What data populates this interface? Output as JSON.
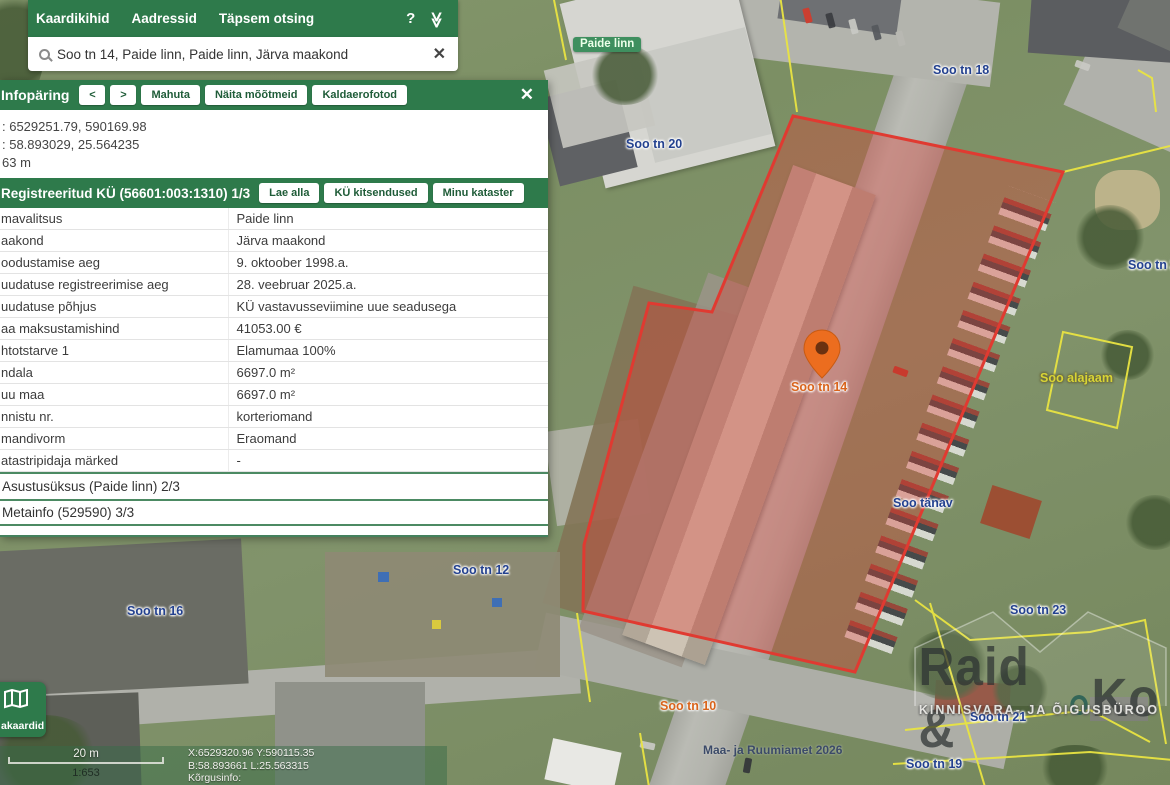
{
  "topbar": {
    "menu": [
      "Kaardikihid",
      "Aadressid",
      "Täpsem otsing"
    ],
    "help_icon": "?",
    "collapse_icon": "≫"
  },
  "search": {
    "value": "Soo tn 14, Paide linn, Paide linn, Järva maakond",
    "clear_icon": "✕"
  },
  "info_panel": {
    "title": "Infopäring",
    "nav_prev": "<",
    "nav_next": ">",
    "toolbar": [
      "Mahuta",
      "Näita mõõtmeid",
      "Kaldaerofotod"
    ],
    "close_icon": "✕",
    "coordinates": {
      "line1": ": 6529251.79, 590169.98",
      "line2": ": 58.893029, 25.564235",
      "line3": "63 m"
    },
    "registered": {
      "title": "Registreeritud KÜ (56601:003:1310) 1/3",
      "buttons": [
        "Lae alla",
        "KÜ kitsendused",
        "Minu kataster"
      ],
      "rows": [
        {
          "label": "mavalitsus",
          "value": "Paide linn"
        },
        {
          "label": "aakond",
          "value": "Järva maakond"
        },
        {
          "label": "oodustamise aeg",
          "value": "9. oktoober 1998.a."
        },
        {
          "label": "uudatuse registreerimise aeg",
          "value": "28. veebruar 2025.a."
        },
        {
          "label": "uudatuse põhjus",
          "value": "KÜ vastavusseviimine uue seadusega"
        },
        {
          "label": "aa maksustamishind",
          "value": "41053.00 €"
        },
        {
          "label": "htotstarve 1",
          "value": "Elamumaa 100%"
        },
        {
          "label": "ndala",
          "value": "6697.0 m²"
        },
        {
          "label": "uu maa",
          "value": "6697.0 m²"
        },
        {
          "label": "nnistu nr.",
          "value": "korteriomand"
        },
        {
          "label": "mandivorm",
          "value": "Eraomand"
        },
        {
          "label": "atastripidaja märked",
          "value": "-"
        }
      ]
    },
    "section2_title": "Asustusüksus (Paide linn) 2/3",
    "section3_title": "Metainfo (529590) 3/3"
  },
  "bottom_left": {
    "maptype_label": "akaardid",
    "scale_label": "20 m",
    "scale_ratio": "1:653",
    "coords_line1": "X:6529320.96 Y:590115.35",
    "coords_line2": "B:58.893661 L:25.563315",
    "coords_line3": "Kõrgusinfo:"
  },
  "map": {
    "labels": [
      {
        "text": "Paide linn",
        "type": "place"
      },
      {
        "text": "Soo tn 18",
        "type": "address"
      },
      {
        "text": "Soo tn 20",
        "type": "address"
      },
      {
        "text": "Soo tn 25",
        "type": "address"
      },
      {
        "text": "Soo alajaam",
        "type": "cadastral"
      },
      {
        "text": "Soo tn 14",
        "type": "highlighted-address"
      },
      {
        "text": "Soo tänav",
        "type": "street"
      },
      {
        "text": "Soo tn 12",
        "type": "address"
      },
      {
        "text": "Soo tn 16",
        "type": "address"
      },
      {
        "text": "Soo tn 23",
        "type": "address"
      },
      {
        "text": "Soo tn 10",
        "type": "highlighted-address"
      },
      {
        "text": "Soo tn 21",
        "type": "address"
      },
      {
        "text": "Soo tn 19",
        "type": "address"
      }
    ],
    "copyright": "Maa- ja Ruumiamet 2026",
    "watermark": {
      "title_part1": "Raid &",
      "title_part2": "Ko",
      "subtitle": "KINNISVARA- JA ÕIGUSBÜROO"
    }
  },
  "colors": {
    "brand_green": "#2e7a4b",
    "link_green": "#4a9b6e",
    "parcel_red": "#e03a31",
    "cadastral_yellow": "#e9e442",
    "label_navy": "#23418f",
    "label_orange": "#d9641c",
    "pin_orange": "#ec6d1f"
  }
}
